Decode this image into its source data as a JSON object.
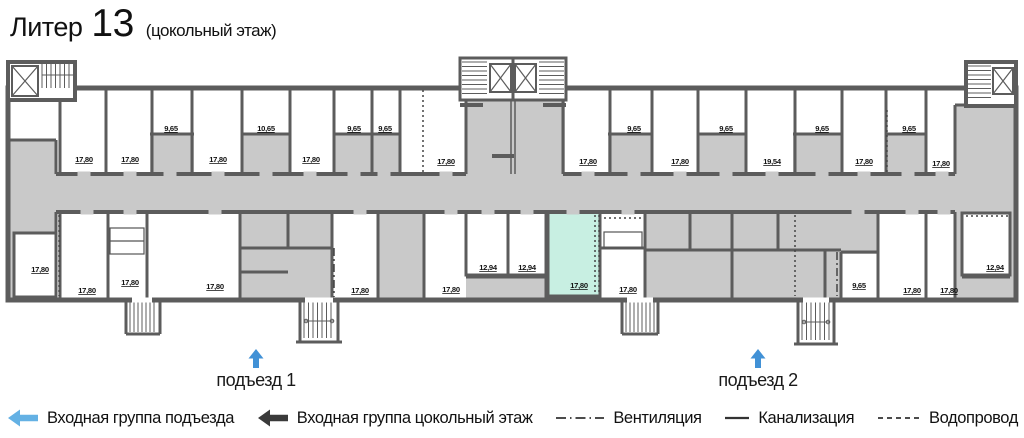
{
  "title": {
    "building": "Литер",
    "number": "13",
    "floor": "(цокольный этаж)"
  },
  "entrances": {
    "e1": "подъезд 1",
    "e2": "подъезд 2"
  },
  "legend": {
    "entry_group": "Входная группа подъезда",
    "entry_group_basement": "Входная группа цокольный этаж",
    "ventilation": "Вентиляция",
    "sewerage": "Канализация",
    "water": "Водопровод"
  },
  "colors": {
    "wall": "#5c5c5c",
    "common_area": "#c9c9c9",
    "highlight": "#c8efe2",
    "plan_arrow": "#4191d6",
    "legend_arrow_blue": "#64b1e4",
    "legend_arrow_black": "#3a3a3a"
  },
  "rooms": [
    {
      "area": "17,80"
    },
    {
      "area": "17,80"
    },
    {
      "area": "9,65"
    },
    {
      "area": "17,80"
    },
    {
      "area": "10,65"
    },
    {
      "area": "17,80"
    },
    {
      "area": "9,65"
    },
    {
      "area": "9,65"
    },
    {
      "area": "17,80"
    },
    {
      "area": "17,80"
    },
    {
      "area": "9,65"
    },
    {
      "area": "17,80"
    },
    {
      "area": "9,65"
    },
    {
      "area": "19,54"
    },
    {
      "area": "9,65"
    },
    {
      "area": "17,80"
    },
    {
      "area": "9,65"
    },
    {
      "area": "17,80"
    },
    {
      "area": "17,80"
    },
    {
      "area": "17,80"
    },
    {
      "area": "17,80"
    },
    {
      "area": "17,80"
    },
    {
      "area": "17,80"
    },
    {
      "area": "17,80"
    },
    {
      "area": "12,94"
    },
    {
      "area": "12,94"
    },
    {
      "area": "17,80"
    },
    {
      "area": "17,80"
    },
    {
      "area": "9,65"
    },
    {
      "area": "17,80"
    },
    {
      "area": "17,80"
    },
    {
      "area": "12,94"
    }
  ]
}
